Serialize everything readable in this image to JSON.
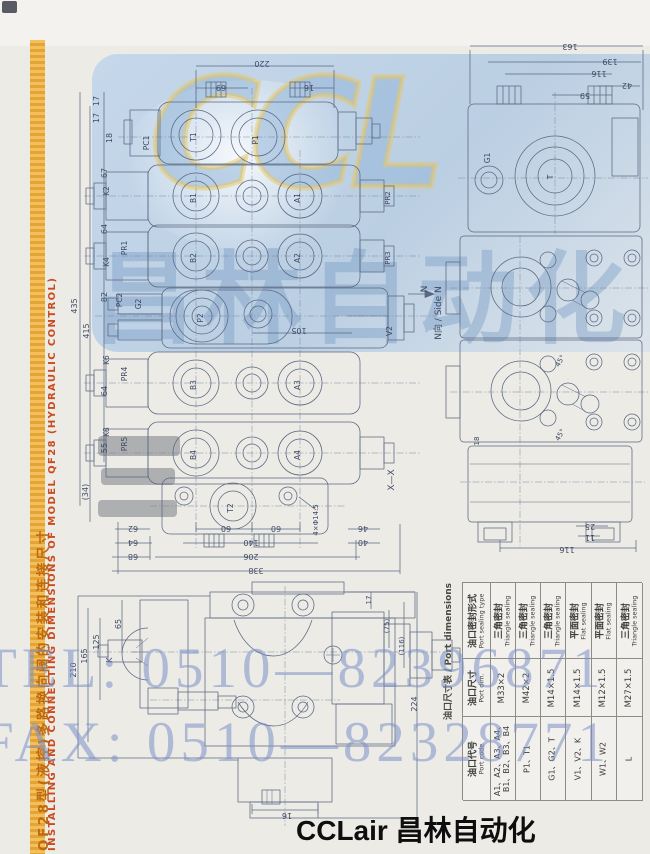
{
  "side_banner": {
    "cn": "QF28型(液控)多路换向阀的安装和连接尺寸",
    "en": "INSTALLING AND CONNECTING DIMENSIONS OF MODEL QF28 (HYDRAULIC CONTROL)"
  },
  "watermark": {
    "logo": "CCL",
    "company": "昌林自动化",
    "tel": "TEL: 0510—82396871",
    "fax": "FAX: 0510—82328771"
  },
  "footer": {
    "brand": "CCLair 昌林自动化"
  },
  "colors": {
    "banner_orange": "#e3a02c",
    "banner_red": "#c94b20",
    "watermark_blue": "#94b6d8",
    "phone_blue": "#7c90c6",
    "line_blue": "#5b6883"
  },
  "port_table": {
    "title": "油口尺寸表 / Port dimensions",
    "headers": [
      {
        "cn": "油口代号",
        "en": "Port code"
      },
      {
        "cn": "油口尺寸",
        "en": "Port dim."
      },
      {
        "cn": "油口密封形式",
        "en": "Port sealing type"
      }
    ],
    "rows": [
      {
        "code": [
          "A1、A2、A3、A4、",
          "B1、B2、B3、B4"
        ],
        "dim": "M33×2",
        "seal": [
          "三角密封",
          "Triangle sealing"
        ]
      },
      {
        "code": [
          "P1、T1"
        ],
        "dim": "M42×2",
        "seal": [
          "三角密封",
          "Triangle sealing"
        ]
      },
      {
        "code": [
          "G1、G2、T"
        ],
        "dim": "M14×1.5",
        "seal": [
          "三角密封",
          "Triangle sealing"
        ]
      },
      {
        "code": [
          "V1、V2、K"
        ],
        "dim": "M14×1.5",
        "seal": [
          "平面密封",
          "Flat sealing"
        ]
      },
      {
        "code": [
          "W1、W2"
        ],
        "dim": "M12×1.5",
        "seal": [
          "平面密封",
          "Flat sealing"
        ]
      },
      {
        "code": [
          "L"
        ],
        "dim": "M27×1.5",
        "seal": [
          "三角密封",
          "Triangle sealing"
        ]
      }
    ]
  },
  "drawing": {
    "labels": [
      {
        "t": "220",
        "x": 262,
        "y": 61,
        "r": 180
      },
      {
        "t": "69",
        "x": 221,
        "y": 85,
        "r": 180
      },
      {
        "t": "16",
        "x": 309,
        "y": 85,
        "r": 180
      },
      {
        "t": "17",
        "x": 99,
        "y": 101,
        "r": -90
      },
      {
        "t": "17",
        "x": 99,
        "y": 118,
        "r": -90
      },
      {
        "t": "18",
        "x": 112,
        "y": 138,
        "r": -90
      },
      {
        "t": "67",
        "x": 107,
        "y": 173,
        "r": -90
      },
      {
        "t": "64",
        "x": 107,
        "y": 229,
        "r": -90
      },
      {
        "t": "82",
        "x": 107,
        "y": 297,
        "r": -90
      },
      {
        "t": "64",
        "x": 107,
        "y": 391,
        "r": -90
      },
      {
        "t": "55",
        "x": 107,
        "y": 448,
        "r": -90
      },
      {
        "t": "(34)",
        "x": 88,
        "y": 492,
        "r": -90
      },
      {
        "t": "435",
        "x": 77,
        "y": 306,
        "r": -90
      },
      {
        "t": "415",
        "x": 89,
        "y": 331,
        "r": -90
      },
      {
        "t": "105",
        "x": 299,
        "y": 328,
        "r": 180
      },
      {
        "t": "X—X",
        "x": 394,
        "y": 480,
        "r": -90,
        "s": 9
      },
      {
        "t": "62",
        "x": 133,
        "y": 526,
        "r": 180
      },
      {
        "t": "64",
        "x": 133,
        "y": 540,
        "r": 180
      },
      {
        "t": "68",
        "x": 133,
        "y": 554,
        "r": 180
      },
      {
        "t": "60",
        "x": 226,
        "y": 526,
        "r": 180
      },
      {
        "t": "60",
        "x": 276,
        "y": 526,
        "r": 180
      },
      {
        "t": "140",
        "x": 251,
        "y": 540,
        "r": 180
      },
      {
        "t": "206",
        "x": 251,
        "y": 554,
        "r": 180
      },
      {
        "t": "338",
        "x": 256,
        "y": 568,
        "r": 180
      },
      {
        "t": "4×Φ14.5",
        "x": 318,
        "y": 520,
        "r": -90,
        "s": 7
      },
      {
        "t": "46",
        "x": 363,
        "y": 526,
        "r": 180
      },
      {
        "t": "40",
        "x": 363,
        "y": 540,
        "r": 180
      },
      {
        "t": "PC1",
        "x": 149,
        "y": 143,
        "r": -90,
        "s": 7.5
      },
      {
        "t": "T1",
        "x": 196,
        "y": 137,
        "r": -90,
        "s": 7.5
      },
      {
        "t": "P1",
        "x": 258,
        "y": 140,
        "r": -90,
        "s": 7.5
      },
      {
        "t": "K2",
        "x": 109,
        "y": 191,
        "r": -90,
        "s": 7.5
      },
      {
        "t": "B1",
        "x": 196,
        "y": 198,
        "r": -90,
        "s": 7.5
      },
      {
        "t": "A1",
        "x": 300,
        "y": 198,
        "r": -90,
        "s": 7.5
      },
      {
        "t": "PR1",
        "x": 127,
        "y": 248,
        "r": -90,
        "s": 7.5
      },
      {
        "t": "K4",
        "x": 109,
        "y": 262,
        "r": -90,
        "s": 7.5
      },
      {
        "t": "B2",
        "x": 196,
        "y": 258,
        "r": -90,
        "s": 7.5
      },
      {
        "t": "A2",
        "x": 300,
        "y": 258,
        "r": -90,
        "s": 7.5
      },
      {
        "t": "PC2",
        "x": 122,
        "y": 300,
        "r": -90,
        "s": 7.5
      },
      {
        "t": "G2",
        "x": 141,
        "y": 304,
        "r": -90,
        "s": 7.5
      },
      {
        "t": "P2",
        "x": 203,
        "y": 318,
        "r": -90,
        "s": 7.5
      },
      {
        "t": "V2",
        "x": 392,
        "y": 331,
        "r": -90,
        "s": 7.5
      },
      {
        "t": "N",
        "x": 427,
        "y": 289,
        "r": -90,
        "s": 9
      },
      {
        "t": "PR2",
        "x": 390,
        "y": 198,
        "r": -90,
        "s": 7
      },
      {
        "t": "PR3",
        "x": 390,
        "y": 258,
        "r": -90,
        "s": 7
      },
      {
        "t": "PR4",
        "x": 127,
        "y": 374,
        "r": -90,
        "s": 7.5
      },
      {
        "t": "K6",
        "x": 109,
        "y": 360,
        "r": -90,
        "s": 7.5
      },
      {
        "t": "B3",
        "x": 196,
        "y": 385,
        "r": -90,
        "s": 7.5
      },
      {
        "t": "A3",
        "x": 300,
        "y": 385,
        "r": -90,
        "s": 7.5
      },
      {
        "t": "PR5",
        "x": 127,
        "y": 444,
        "r": -90,
        "s": 7.5
      },
      {
        "t": "K8",
        "x": 109,
        "y": 432,
        "r": -90,
        "s": 7.5
      },
      {
        "t": "B4",
        "x": 196,
        "y": 455,
        "r": -90,
        "s": 7.5
      },
      {
        "t": "A4",
        "x": 300,
        "y": 455,
        "r": -90,
        "s": 7.5
      },
      {
        "t": "T2",
        "x": 233,
        "y": 508,
        "r": -90,
        "s": 7.5
      },
      {
        "t": "163",
        "x": 570,
        "y": 44,
        "r": 180
      },
      {
        "t": "139",
        "x": 610,
        "y": 59,
        "r": 180
      },
      {
        "t": "116",
        "x": 599,
        "y": 71,
        "r": 180
      },
      {
        "t": "42",
        "x": 627,
        "y": 83,
        "r": 180
      },
      {
        "t": "59",
        "x": 585,
        "y": 93,
        "r": 180
      },
      {
        "t": "G1",
        "x": 490,
        "y": 158,
        "r": -90,
        "s": 7.5
      },
      {
        "t": "T",
        "x": 553,
        "y": 177,
        "r": -90,
        "s": 7.5
      },
      {
        "t": "45°",
        "x": 562,
        "y": 362,
        "r": -60,
        "s": 7
      },
      {
        "t": "45°",
        "x": 562,
        "y": 436,
        "r": -60,
        "s": 7
      },
      {
        "t": "18",
        "x": 479,
        "y": 441,
        "r": -90,
        "s": 7
      },
      {
        "t": "25",
        "x": 590,
        "y": 524,
        "r": 180
      },
      {
        "t": "11",
        "x": 590,
        "y": 535,
        "r": 180
      },
      {
        "t": "116",
        "x": 567,
        "y": 547,
        "r": 180
      },
      {
        "t": "N向 / Side N",
        "x": 441,
        "y": 313,
        "r": -90,
        "s": 9
      },
      {
        "t": "210",
        "x": 76,
        "y": 670,
        "r": -90
      },
      {
        "t": "165",
        "x": 87,
        "y": 656,
        "r": -90
      },
      {
        "t": "125",
        "x": 99,
        "y": 642,
        "r": -90
      },
      {
        "t": "65",
        "x": 121,
        "y": 624,
        "r": -90
      },
      {
        "t": "K",
        "x": 112,
        "y": 660,
        "r": -90,
        "s": 7.5
      },
      {
        "t": "17",
        "x": 371,
        "y": 600,
        "r": -90,
        "s": 7
      },
      {
        "t": "(75)",
        "x": 389,
        "y": 626,
        "r": -90,
        "s": 7
      },
      {
        "t": "(116)",
        "x": 404,
        "y": 646,
        "r": -90,
        "s": 7
      },
      {
        "t": "224",
        "x": 417,
        "y": 704,
        "r": -90
      },
      {
        "t": "16",
        "x": 287,
        "y": 813,
        "r": 180
      }
    ]
  }
}
